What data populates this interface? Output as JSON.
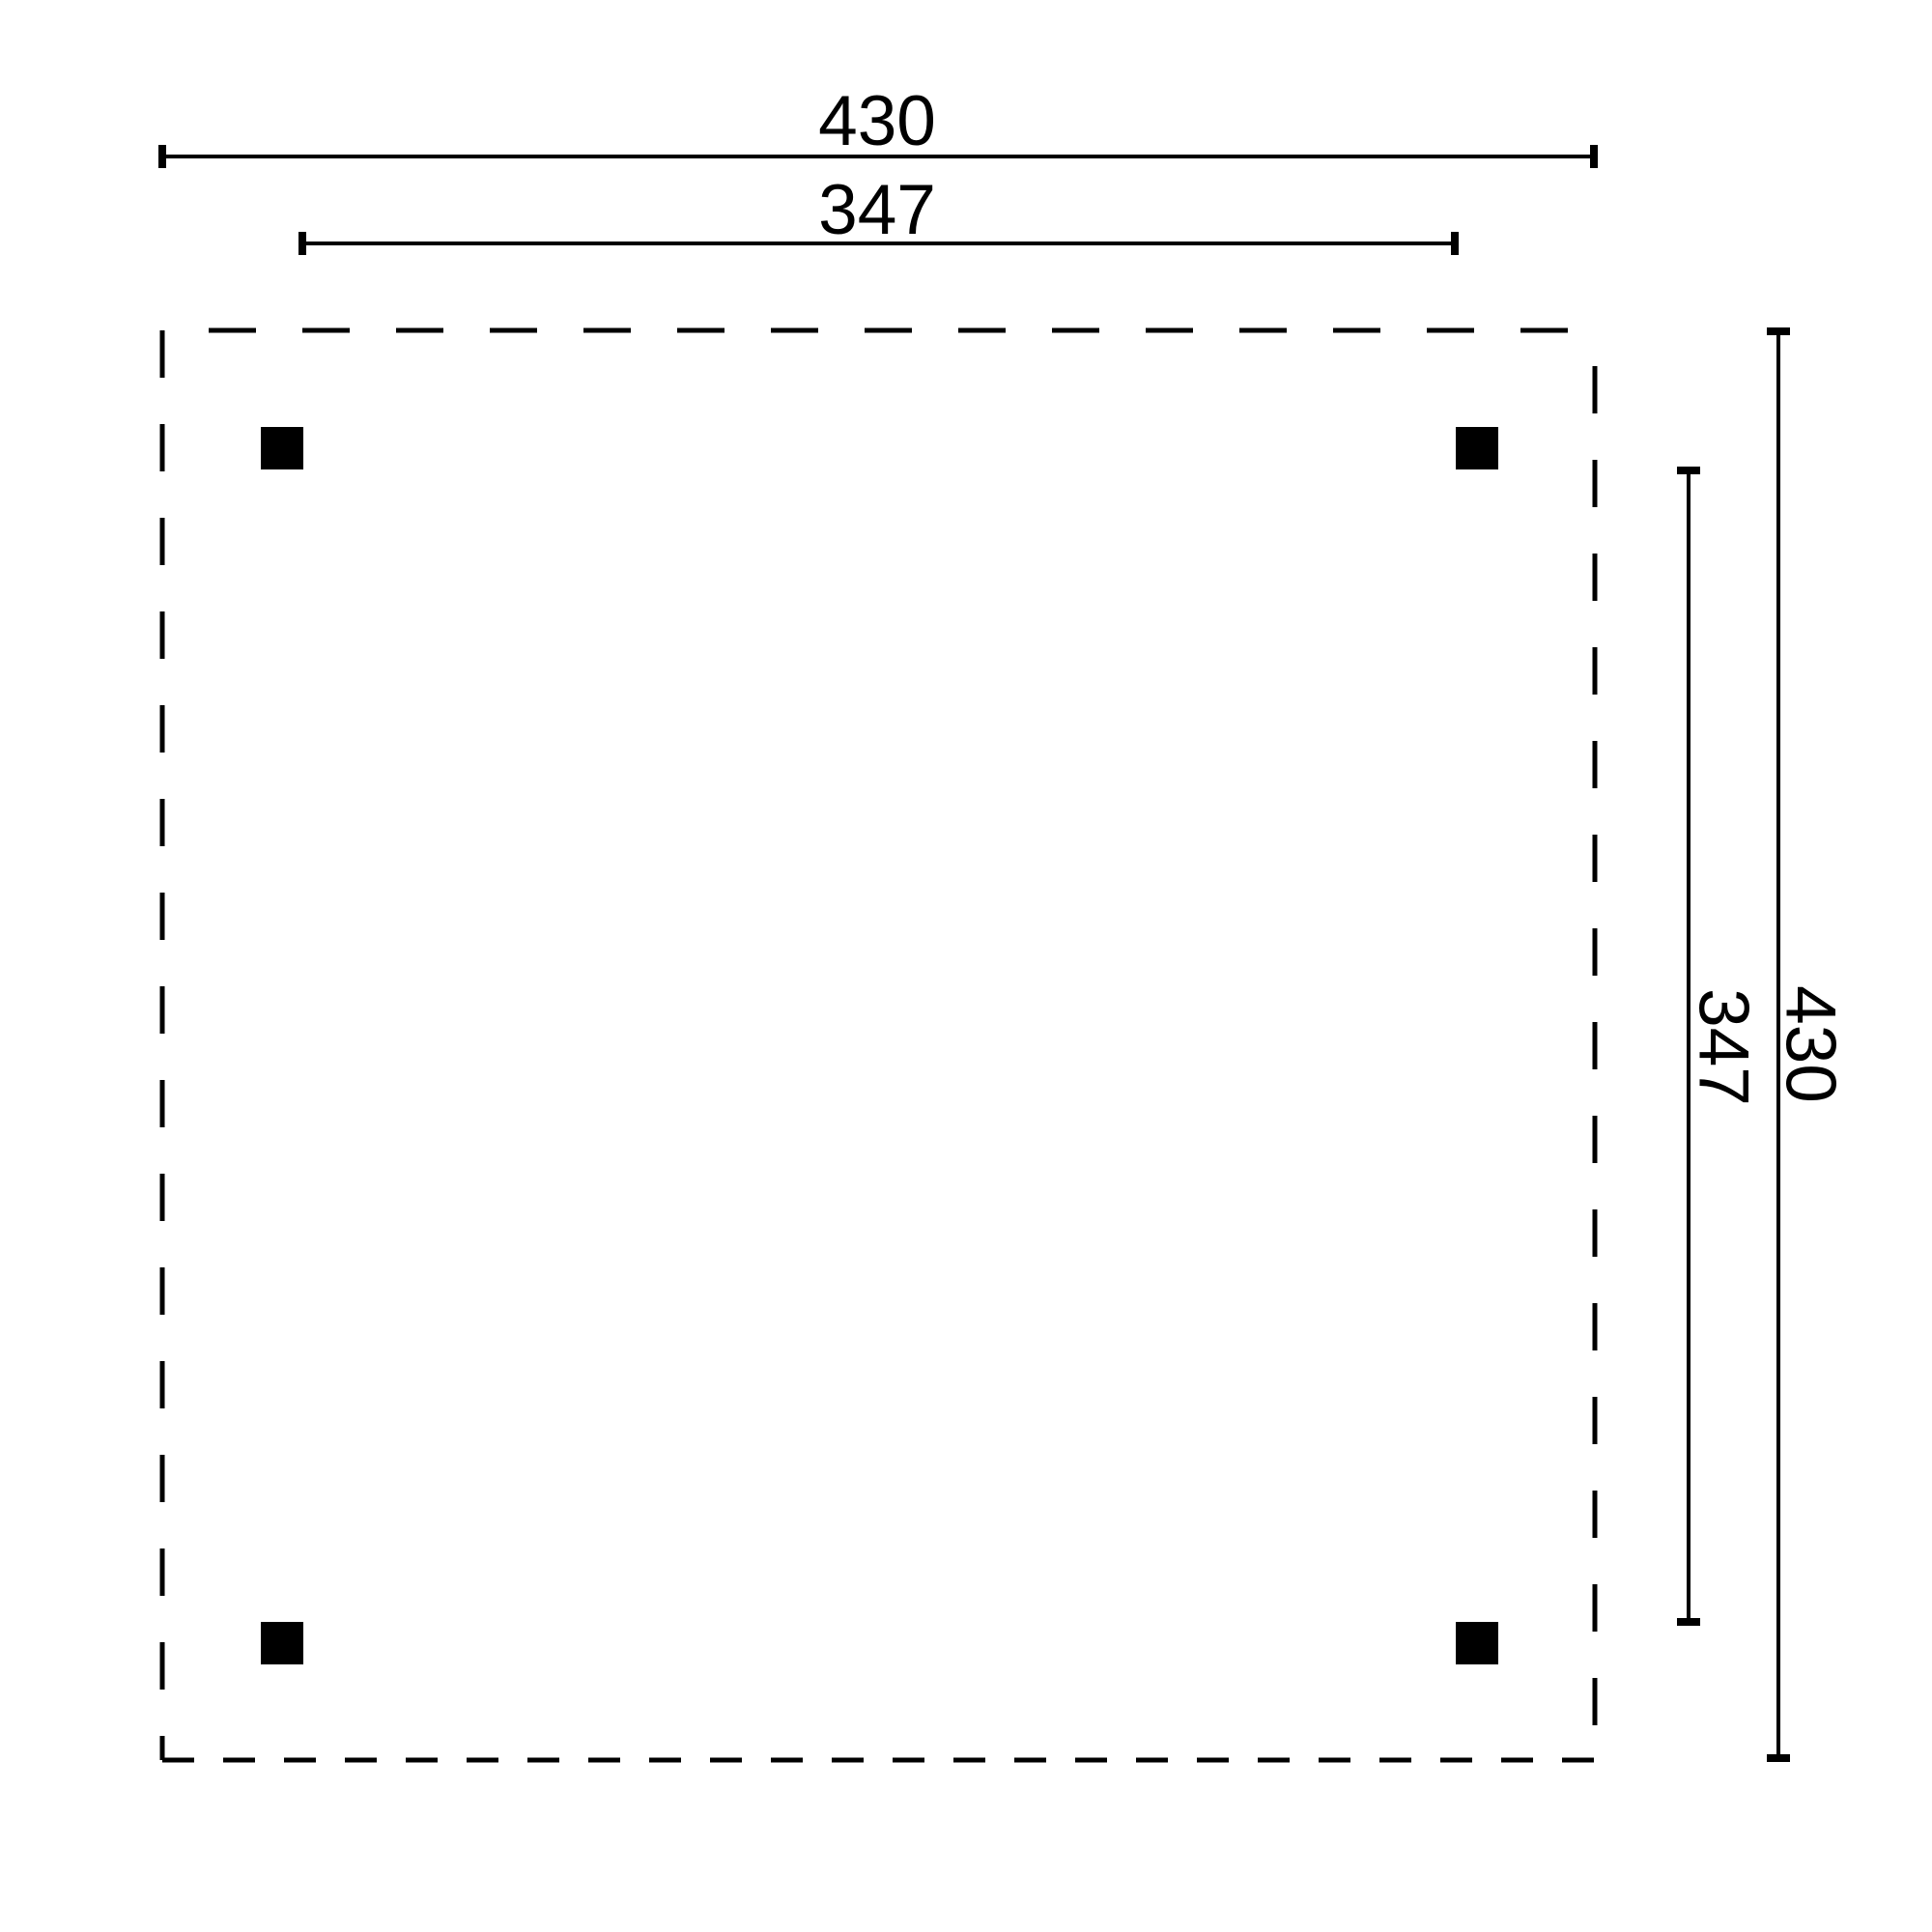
{
  "diagram": {
    "dimensions": {
      "width_overall": "430",
      "width_between_posts": "347",
      "depth_overall": "430",
      "depth_between_posts": "347"
    },
    "post_count": "4",
    "colors": {
      "ink": "#000000",
      "post": "#000000",
      "background": "#ffffff"
    }
  }
}
